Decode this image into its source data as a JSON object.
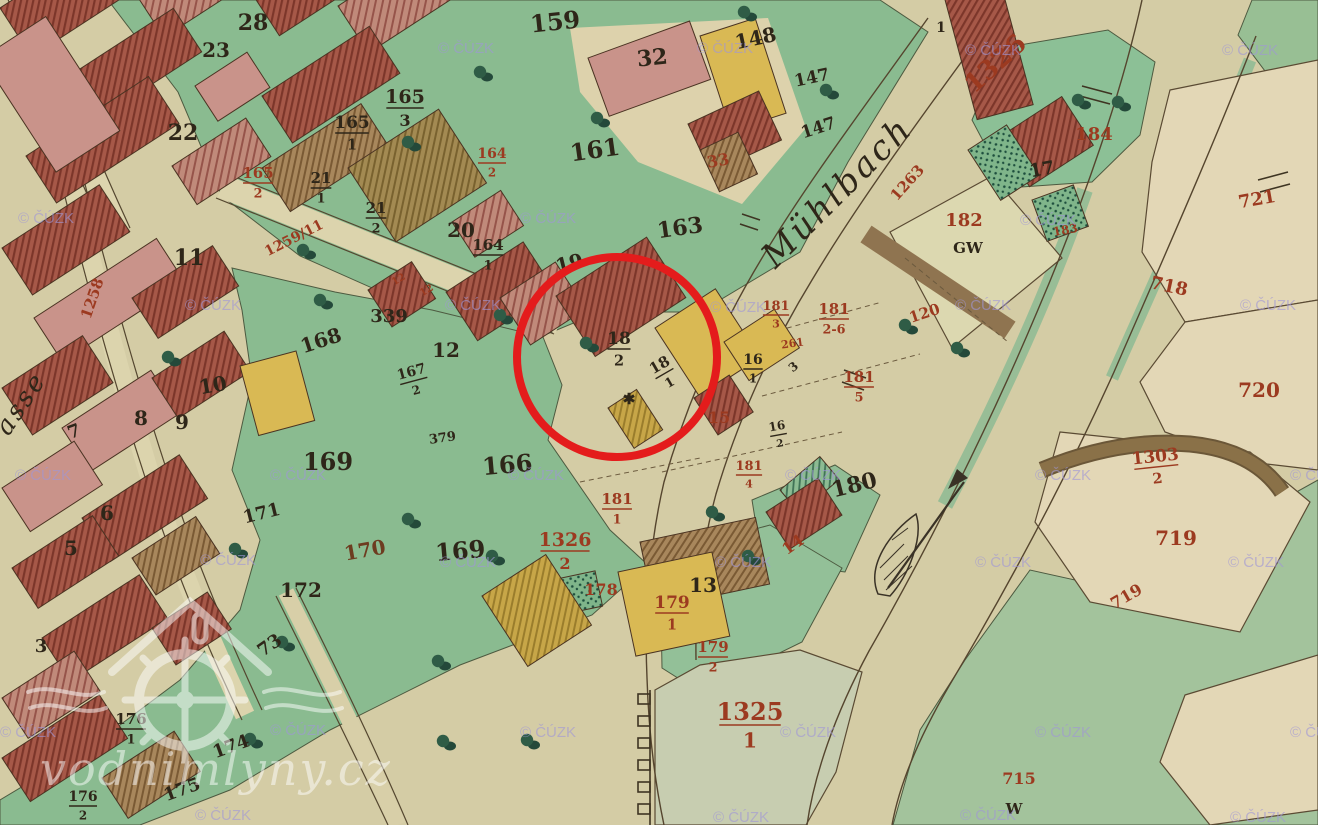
{
  "page": {
    "description": "Historical cadastral map scan with red highlight circle over mill parcels 18/2 and 18/1"
  },
  "map": {
    "stream_label": "Mühlbach",
    "street_label_fragment": "asse",
    "ink_colors": {
      "black": "#2e2619",
      "red": "#9c3a20",
      "brown": "#6d3c20"
    },
    "highlight_circle": {
      "color": "#e41c1c"
    },
    "labels": [
      {
        "t": "28",
        "x": 253,
        "y": 30,
        "c": "black",
        "s": 22
      },
      {
        "t": "23",
        "x": 216,
        "y": 57,
        "c": "black",
        "s": 20
      },
      {
        "t": "22",
        "x": 183,
        "y": 140,
        "c": "black",
        "s": 22
      },
      {
        "t": "159",
        "x": 556,
        "y": 30,
        "c": "black",
        "s": 24,
        "a": -6
      },
      {
        "t": "32",
        "x": 653,
        "y": 65,
        "c": "black",
        "s": 22,
        "a": -6
      },
      {
        "t": "148",
        "x": 757,
        "y": 45,
        "c": "black",
        "s": 20,
        "a": -12
      },
      {
        "t": "147",
        "x": 813,
        "y": 83,
        "c": "black",
        "s": 17,
        "a": -12
      },
      {
        "t": "147",
        "x": 820,
        "y": 133,
        "c": "black",
        "s": 17,
        "a": -18
      },
      {
        "t": "161",
        "x": 596,
        "y": 158,
        "c": "black",
        "s": 24,
        "a": -8
      },
      {
        "t": "165",
        "d": "3",
        "x": 405,
        "y": 105,
        "c": "black",
        "s": 19
      },
      {
        "t": "165",
        "d": "1",
        "x": 352,
        "y": 130,
        "c": "black",
        "s": 17
      },
      {
        "t": "165",
        "d": "2",
        "x": 258,
        "y": 180,
        "c": "red",
        "s": 15
      },
      {
        "t": "21",
        "d": "1",
        "x": 321,
        "y": 185,
        "c": "black",
        "s": 15
      },
      {
        "t": "21",
        "d": "2",
        "x": 376,
        "y": 215,
        "c": "black",
        "s": 15
      },
      {
        "t": "20",
        "x": 461,
        "y": 237,
        "c": "black",
        "s": 20
      },
      {
        "t": "163",
        "x": 681,
        "y": 235,
        "c": "black",
        "s": 22,
        "a": -8
      },
      {
        "t": "164",
        "d": "2",
        "x": 492,
        "y": 160,
        "c": "red",
        "s": 14
      },
      {
        "t": "164",
        "d": "1",
        "x": 488,
        "y": 252,
        "c": "black",
        "s": 15
      },
      {
        "t": "19",
        "x": 571,
        "y": 270,
        "c": "black",
        "s": 20,
        "a": -14
      },
      {
        "t": "11",
        "x": 189,
        "y": 265,
        "c": "black",
        "s": 22
      },
      {
        "t": "1259/11",
        "x": 296,
        "y": 242,
        "c": "red",
        "s": 14,
        "a": -27
      },
      {
        "t": "1258",
        "x": 97,
        "y": 300,
        "c": "red",
        "s": 15,
        "a": -71
      },
      {
        "t": "339",
        "x": 389,
        "y": 322,
        "c": "black",
        "s": 18
      },
      {
        "t": "168",
        "x": 323,
        "y": 347,
        "c": "black",
        "s": 20,
        "a": -18
      },
      {
        "t": "12",
        "x": 446,
        "y": 357,
        "c": "black",
        "s": 20
      },
      {
        "t": "167",
        "d": "2",
        "x": 413,
        "y": 378,
        "c": "black",
        "s": 14,
        "a": -15
      },
      {
        "t": "10",
        "x": 214,
        "y": 392,
        "c": "black",
        "s": 20,
        "a": -10
      },
      {
        "t": "7",
        "x": 76,
        "y": 437,
        "c": "black",
        "s": 18,
        "a": -20
      },
      {
        "t": "8",
        "x": 141,
        "y": 425,
        "c": "black",
        "s": 20
      },
      {
        "t": "9",
        "x": 182,
        "y": 429,
        "c": "black",
        "s": 20
      },
      {
        "t": "6",
        "x": 107,
        "y": 520,
        "c": "black",
        "s": 20
      },
      {
        "t": "5",
        "x": 71,
        "y": 555,
        "c": "black",
        "s": 20
      },
      {
        "t": "3",
        "x": 41,
        "y": 652,
        "c": "black",
        "s": 18
      },
      {
        "t": "171",
        "x": 263,
        "y": 519,
        "c": "black",
        "s": 18,
        "a": -14
      },
      {
        "t": "172",
        "x": 301,
        "y": 597,
        "c": "black",
        "s": 20
      },
      {
        "t": "169",
        "x": 328,
        "y": 470,
        "c": "black",
        "s": 24
      },
      {
        "t": "169",
        "x": 461,
        "y": 559,
        "c": "black",
        "s": 24,
        "a": -5
      },
      {
        "t": "166",
        "x": 508,
        "y": 473,
        "c": "black",
        "s": 24,
        "a": -5
      },
      {
        "t": "379",
        "x": 443,
        "y": 442,
        "c": "black",
        "s": 13,
        "a": -8
      },
      {
        "t": "73",
        "x": 273,
        "y": 650,
        "c": "black",
        "s": 18,
        "a": -35
      },
      {
        "t": "176",
        "d": "1",
        "x": 131,
        "y": 726,
        "c": "black",
        "s": 15
      },
      {
        "t": "174",
        "x": 233,
        "y": 752,
        "c": "black",
        "s": 18,
        "a": -20
      },
      {
        "t": "175",
        "x": 184,
        "y": 795,
        "c": "black",
        "s": 18,
        "a": -20
      },
      {
        "t": "176",
        "d": "2",
        "x": 83,
        "y": 803,
        "c": "black",
        "s": 14
      },
      {
        "t": "170",
        "x": 366,
        "y": 557,
        "c": "brown",
        "s": 20,
        "a": -10
      },
      {
        "t": "18",
        "d": "2",
        "x": 619,
        "y": 346,
        "c": "black",
        "s": 17
      },
      {
        "t": "18",
        "d": "1",
        "x": 663,
        "y": 371,
        "c": "black",
        "s": 15,
        "a": -30
      },
      {
        "t": "16",
        "d": "1",
        "x": 753,
        "y": 366,
        "c": "black",
        "s": 14
      },
      {
        "t": "3",
        "x": 796,
        "y": 370,
        "c": "black",
        "s": 12,
        "a": -40
      },
      {
        "t": "16",
        "d": "2",
        "x": 778,
        "y": 432,
        "c": "black",
        "s": 12,
        "a": -10
      },
      {
        "t": "13",
        "x": 703,
        "y": 592,
        "c": "black",
        "s": 20
      },
      {
        "t": "180",
        "x": 856,
        "y": 492,
        "c": "black",
        "s": 22,
        "a": -14
      },
      {
        "t": "1",
        "x": 941,
        "y": 32,
        "c": "black",
        "s": 14
      },
      {
        "t": "17",
        "x": 1043,
        "y": 175,
        "c": "black",
        "s": 18,
        "a": -10
      },
      {
        "t": "GW",
        "x": 968,
        "y": 253,
        "c": "black",
        "s": 15
      },
      {
        "t": "W",
        "x": 1014,
        "y": 814,
        "c": "black",
        "s": 15
      },
      {
        "t": "✱",
        "x": 629,
        "y": 404,
        "c": "black",
        "s": 15
      },
      {
        "t": "33",
        "x": 719,
        "y": 166,
        "c": "red",
        "s": 16,
        "a": -10
      },
      {
        "t": "261",
        "x": 793,
        "y": 347,
        "c": "red",
        "s": 11,
        "a": -8
      },
      {
        "t": "181",
        "d": "3",
        "x": 776,
        "y": 312,
        "c": "red",
        "s": 13
      },
      {
        "t": "181",
        "d": "2-6",
        "x": 834,
        "y": 316,
        "c": "red",
        "s": 15
      },
      {
        "t": "181",
        "d": "5",
        "x": 859,
        "y": 384,
        "c": "red",
        "s": 15
      },
      {
        "t": "181",
        "d": "4",
        "x": 749,
        "y": 472,
        "c": "red",
        "s": 13
      },
      {
        "t": "181",
        "d": "1",
        "x": 617,
        "y": 506,
        "c": "red",
        "s": 15
      },
      {
        "t": "15",
        "x": 719,
        "y": 423,
        "c": "red",
        "s": 16
      },
      {
        "t": "14",
        "x": 796,
        "y": 549,
        "c": "red",
        "s": 16,
        "a": -35
      },
      {
        "t": "178",
        "x": 601,
        "y": 595,
        "c": "red",
        "s": 16
      },
      {
        "t": "179",
        "d": "1",
        "x": 672,
        "y": 610,
        "c": "red",
        "s": 17
      },
      {
        "t": "179",
        "d": "2",
        "x": 713,
        "y": 654,
        "c": "red",
        "s": 15
      },
      {
        "t": "1326",
        "d": "2",
        "x": 565,
        "y": 548,
        "c": "red",
        "s": 19
      },
      {
        "t": "1325",
        "d": "1",
        "x": 750,
        "y": 722,
        "c": "red",
        "s": 24
      },
      {
        "t": "1326",
        "x": 1001,
        "y": 70,
        "c": "red",
        "s": 26,
        "a": -42
      },
      {
        "t": "1263",
        "x": 911,
        "y": 186,
        "c": "red",
        "s": 15,
        "a": -48
      },
      {
        "t": "182",
        "x": 964,
        "y": 226,
        "c": "red",
        "s": 18
      },
      {
        "t": "183",
        "x": 1066,
        "y": 234,
        "c": "red",
        "s": 12,
        "a": -10
      },
      {
        "t": "184",
        "x": 1094,
        "y": 140,
        "c": "red",
        "s": 18
      },
      {
        "t": "120",
        "x": 926,
        "y": 318,
        "c": "red",
        "s": 15,
        "a": -18
      },
      {
        "t": "718",
        "x": 1168,
        "y": 292,
        "c": "red",
        "s": 18,
        "a": 12
      },
      {
        "t": "721",
        "x": 1258,
        "y": 205,
        "c": "red",
        "s": 18,
        "a": -10
      },
      {
        "t": "720",
        "x": 1259,
        "y": 397,
        "c": "red",
        "s": 20
      },
      {
        "t": "1303",
        "d": "2",
        "x": 1156,
        "y": 464,
        "c": "red",
        "s": 17,
        "a": -6
      },
      {
        "t": "719",
        "x": 1176,
        "y": 545,
        "c": "red",
        "s": 20
      },
      {
        "t": "719",
        "x": 1129,
        "y": 601,
        "c": "red",
        "s": 16,
        "a": -30
      },
      {
        "t": "715",
        "x": 1019,
        "y": 784,
        "c": "red",
        "s": 16
      },
      {
        "t": "12",
        "x": 400,
        "y": 282,
        "c": "red",
        "s": 10,
        "a": -30
      },
      {
        "t": "12",
        "x": 428,
        "y": 293,
        "c": "red",
        "s": 10,
        "a": -30
      },
      {
        "t": "Mühlbach",
        "x": 845,
        "y": 200,
        "c": "black",
        "s": 34,
        "a": -45,
        "i": true
      },
      {
        "t": "asse",
        "x": 28,
        "y": 408,
        "c": "black",
        "s": 26,
        "a": -56,
        "i": true
      }
    ],
    "trees": [
      [
        480,
        72
      ],
      [
        597,
        118
      ],
      [
        408,
        142
      ],
      [
        303,
        250
      ],
      [
        320,
        300
      ],
      [
        586,
        343
      ],
      [
        826,
        90
      ],
      [
        744,
        12
      ],
      [
        1078,
        100
      ],
      [
        1118,
        102
      ],
      [
        905,
        325
      ],
      [
        957,
        348
      ],
      [
        500,
        315
      ],
      [
        168,
        357
      ],
      [
        235,
        549
      ],
      [
        408,
        519
      ],
      [
        492,
        556
      ],
      [
        712,
        512
      ],
      [
        748,
        556
      ],
      [
        282,
        642
      ],
      [
        438,
        661
      ],
      [
        250,
        739
      ],
      [
        443,
        741
      ],
      [
        527,
        740
      ]
    ],
    "watermarks": {
      "cuzk_text": "© ČÚZK",
      "site_text": "vodnimlyny.cz",
      "cuzk_positions": [
        [
          438,
          53
        ],
        [
          697,
          53
        ],
        [
          965,
          55
        ],
        [
          1222,
          55
        ],
        [
          18,
          223
        ],
        [
          520,
          223
        ],
        [
          1020,
          225
        ],
        [
          185,
          310
        ],
        [
          445,
          310
        ],
        [
          710,
          312
        ],
        [
          955,
          310
        ],
        [
          1240,
          310
        ],
        [
          15,
          480
        ],
        [
          270,
          480
        ],
        [
          508,
          480
        ],
        [
          785,
          480
        ],
        [
          1035,
          480
        ],
        [
          1290,
          480
        ],
        [
          200,
          565
        ],
        [
          440,
          567
        ],
        [
          715,
          567
        ],
        [
          975,
          567
        ],
        [
          1228,
          567
        ],
        [
          0,
          737
        ],
        [
          270,
          735
        ],
        [
          520,
          737
        ],
        [
          780,
          737
        ],
        [
          1035,
          737
        ],
        [
          1290,
          737
        ],
        [
          195,
          820
        ],
        [
          713,
          822
        ],
        [
          960,
          820
        ],
        [
          1230,
          822
        ]
      ]
    }
  }
}
